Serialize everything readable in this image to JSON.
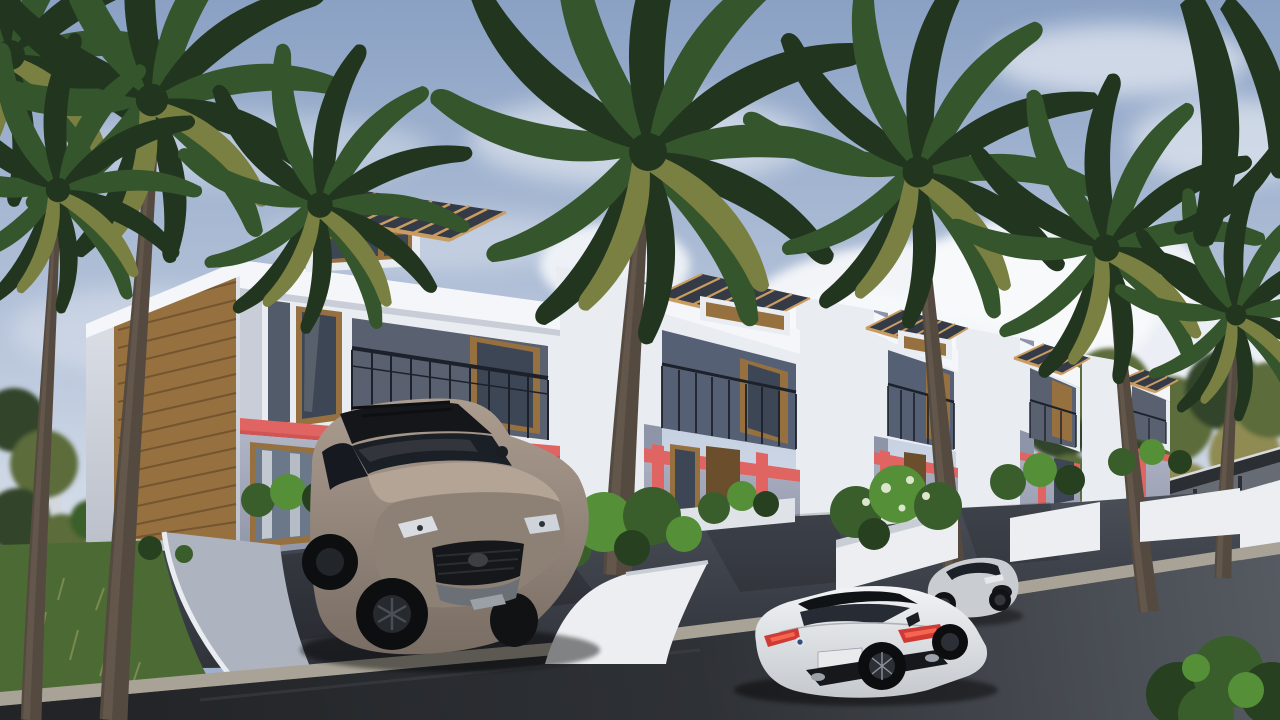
{
  "scene": {
    "type": "architectural-exterior-3d-render",
    "description": "Row of five modern two-story townhouses with rooftop pergolas, balconies, coral accent bands and wood-slat cladding; tall palm trees; taupe SUV parked in a driveway; white sports sedan on the street; silver coupe in a second driveway; dark asphalt road with light curb in the foreground; partly cloudy daytime sky.",
    "time_of_day": "day",
    "weather": "partly cloudy"
  },
  "objects": {
    "townhouse_count": 5,
    "palm_tree_count": 8,
    "vehicles": [
      "taupe-suv",
      "white-sports-sedan",
      "silver-coupe"
    ],
    "features": [
      "rooftop-pergolas",
      "balconies-with-dark-railings",
      "coral-accent-bands",
      "wood-slat-cladding",
      "white-planters-with-shrubs",
      "grass-lawn",
      "curved-garden-walls",
      "asphalt-street-with-light-curb",
      "guardrail-on-rising-road",
      "background-trees"
    ]
  },
  "palette": {
    "sky_top": "#8aa1c4",
    "sky_mid": "#b6c4da",
    "sky_horizon": "#e0e6ee",
    "cloud": "#f7f9fb",
    "white_wall": "#e9ecf1",
    "fascia_bright": "#f4f6f9",
    "side_shade": "#d6dae2",
    "wall_shade": "#c3c8d2",
    "ground_wall": "#a7adbe",
    "ground_wall_dark": "#8f95a8",
    "accent": "#e06562",
    "accent_dark": "#c34b4b",
    "wood": "#96713f",
    "wood_light": "#b48e55",
    "wood_dark": "#6b4f2c",
    "glass": "#3d4654",
    "glass_light": "#6b7889",
    "railing": "#1c212b",
    "pergola_tan": "#c99d62",
    "pergola_dark": "#343a46",
    "trunk": "#554a40",
    "trunk_light": "#706355",
    "palm_dark": "#22361f",
    "palm_mid": "#35552c",
    "palm_light": "#4e7a38",
    "palm_dry": "#7a7f42",
    "grass": "#4c6a34",
    "bush_dark": "#27401f",
    "bush_mid": "#3a5e2b",
    "bush_light": "#559038",
    "bush_flower": "#dce6cc",
    "planter": "#eceef1",
    "planter_shade": "#c9ced6",
    "asphalt": "#3b3f47",
    "road_dark": "#26282c",
    "road_light": "#51565e",
    "curb": "#a8a396",
    "guardrail": "#2b2e33",
    "tree_olive": "#5c6c3b",
    "tree_dark": "#31452a",
    "tree_yellow": "#8f8b52",
    "suv_body": "#9a8b80",
    "suv_dark": "#7b6f66",
    "sedan_body": "#eceef0",
    "tail_red": "#cf3b34",
    "coupe_body": "#c9cdd2"
  }
}
